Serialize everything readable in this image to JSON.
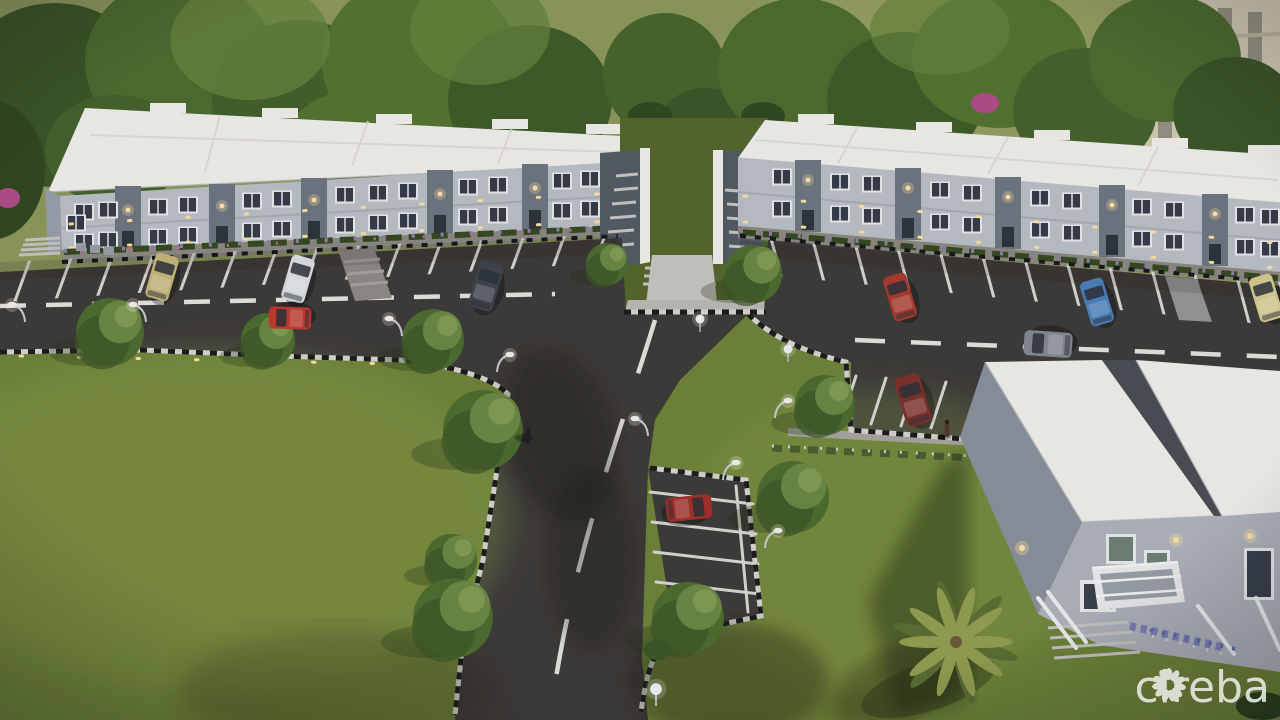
{
  "scene": {
    "type": "aerial-3d-architectural-rendering",
    "time_of_day": "dusk",
    "setting": "residential development with two grey two-storey apartment blocks, parking lots, central access road, lawns and a foreground building"
  },
  "watermark": {
    "text": "cireba",
    "icon": "flower-petals-icon",
    "color": "#e4e7df"
  },
  "palette": {
    "field": "#8e995c",
    "lawn": "#6f8438",
    "lawn_shade": "#55682c",
    "tree_dark": "#3c5626",
    "tree_mid": "#4d6c2f",
    "tree_light": "#6f8d46",
    "asphalt": "#3e3b38",
    "asphalt_shadow": "#242220",
    "marking_white": "#d9d8d3",
    "roof_white": "#f3f1ec",
    "wall_light": "#bcc1c8",
    "wall_mid": "#9aa1ab",
    "bay_dark": "#6e7681",
    "tower_dark": "#535b65",
    "walkway": "#c9c7c1",
    "sidewalk": "#8d8984",
    "window_glass": "#363d47",
    "window_frame": "#e9ebec",
    "warm_light": "#ffe1a0",
    "flower_pink": "#c06a9a",
    "flower_purple": "#8f7fae",
    "palm_frond": "#93a050",
    "fg_wall": "#aeb4bc",
    "fg_wall_shade": "#8b929c",
    "bg_house_roof": "#3a3f45",
    "bg_house_wall": "#e9e7e2",
    "bg_tower_wall": "#d3cdb6"
  },
  "buildings": [
    {
      "name": "apartment-block-left",
      "storeys": 2,
      "roof": "flat white",
      "stair_bays": 5
    },
    {
      "name": "apartment-block-right",
      "storeys": 2,
      "roof": "flat white",
      "stair_bays": 5
    },
    {
      "name": "foreground-building",
      "storeys": 2,
      "features": "balcony, entrance stairs, flower beds"
    },
    {
      "name": "background-house",
      "roof": "dark gable"
    },
    {
      "name": "background-tower",
      "facade": "beige classical with window rows"
    }
  ],
  "vehicles": [
    {
      "name": "tan-sedan",
      "color": "#c7b77a"
    },
    {
      "name": "white-sedan",
      "color": "#dde1e4"
    },
    {
      "name": "dark-grey-suv",
      "color": "#3f444b"
    },
    {
      "name": "red-sports-car",
      "color": "#c13a2e"
    },
    {
      "name": "red-sedan",
      "color": "#a93a2c"
    },
    {
      "name": "blue-hatchback",
      "color": "#4b80bd"
    },
    {
      "name": "silver-sedan",
      "color": "#858a90"
    },
    {
      "name": "maroon-suv",
      "color": "#7e302a"
    },
    {
      "name": "beige-car",
      "color": "#d6cd92"
    },
    {
      "name": "red-hatchback",
      "color": "#a52f28"
    }
  ],
  "figures": [
    {
      "name": "cyclist"
    },
    {
      "name": "pedestrian"
    }
  ],
  "landscape": {
    "round_trees": 11,
    "palm_trees": 1,
    "street_lamps": 11,
    "flower_beds": "purple and pink shrubs along building bases and walkways"
  }
}
